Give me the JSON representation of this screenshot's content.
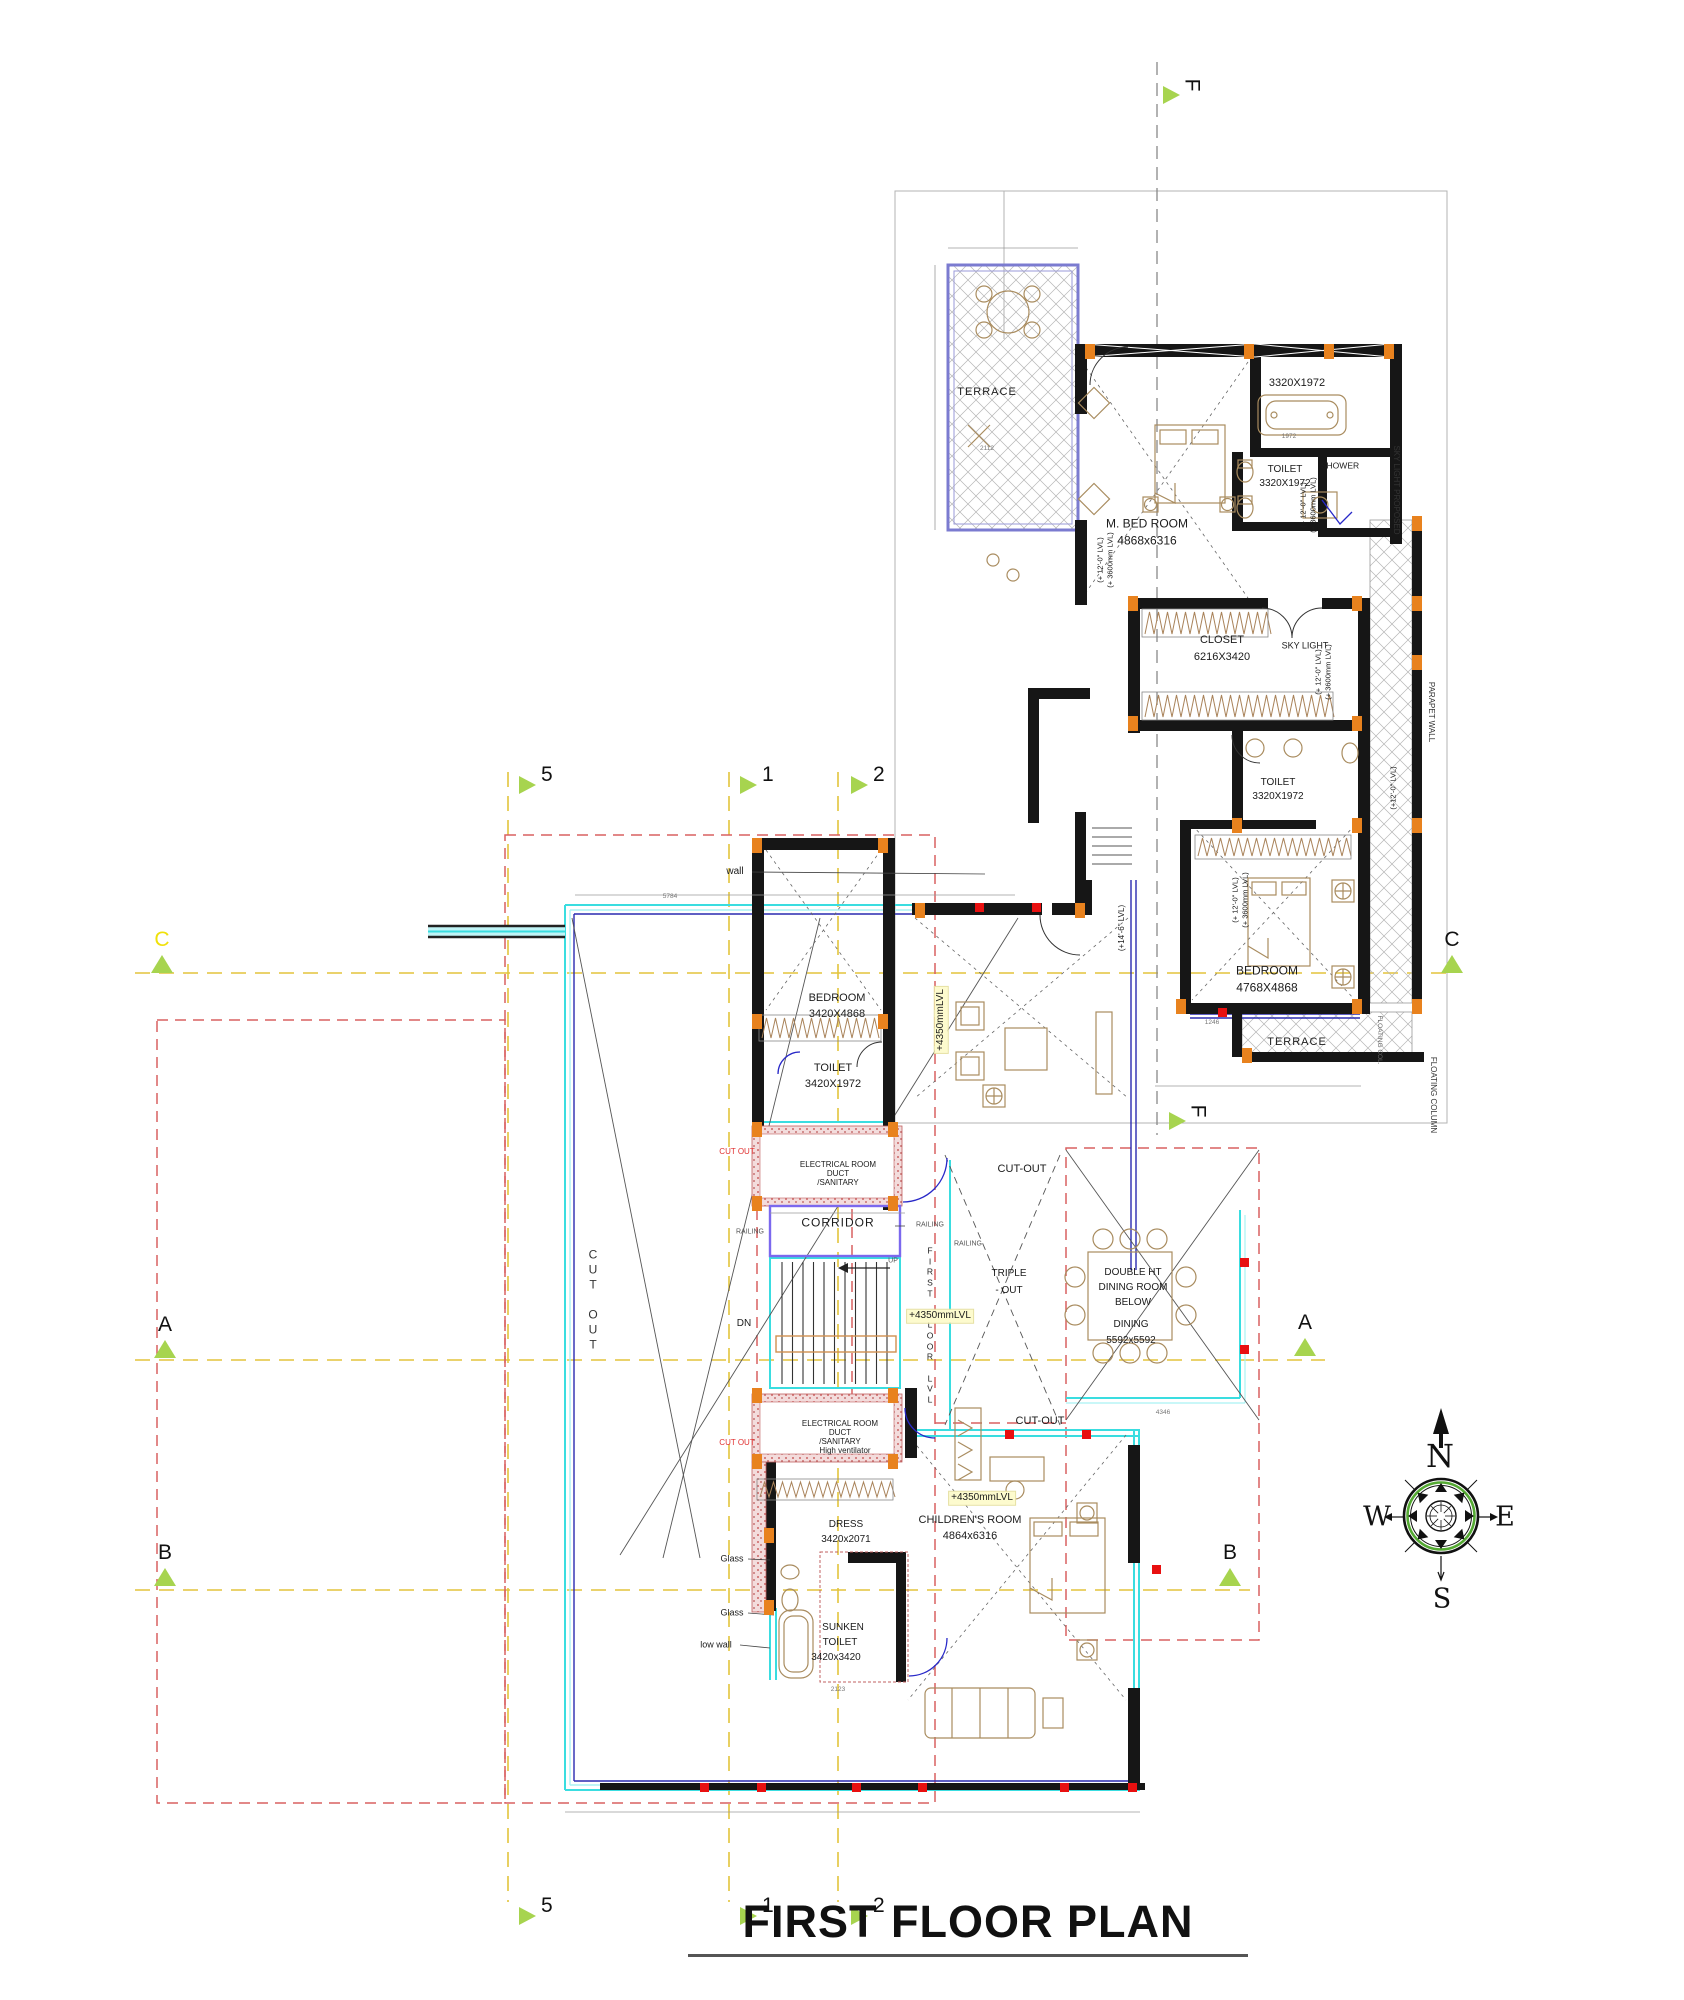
{
  "title": {
    "text": "FIRST FLOOR PLAN"
  },
  "compass": {
    "n": "N",
    "e": "E",
    "s": "S",
    "w": "W"
  },
  "colors": {
    "accent_green": "#a7d44f",
    "grid_yellow": "#e3c43c",
    "wall_black": "#161616",
    "column_orange": "#e8821e",
    "marker_red": "#e81010",
    "cyan": "#3adde0",
    "red_dash": "#d96060",
    "navy": "#4040bb",
    "highlight_yellow": "#fdfbce",
    "label_yellow": "#f0e10a"
  },
  "section_markers": [
    {
      "label": "F",
      "x": 1163,
      "y": 86,
      "dir": "r",
      "lr": 90
    },
    {
      "label": "F",
      "x": 1169,
      "y": 1112,
      "dir": "r",
      "lr": 90
    },
    {
      "label": "5",
      "x": 519,
      "y": 776,
      "dir": "r"
    },
    {
      "label": "1",
      "x": 740,
      "y": 776,
      "dir": "r"
    },
    {
      "label": "2",
      "x": 851,
      "y": 776,
      "dir": "r"
    },
    {
      "label": "5",
      "x": 519,
      "y": 1907,
      "dir": "r"
    },
    {
      "label": "1",
      "x": 740,
      "y": 1907,
      "dir": "r"
    },
    {
      "label": "2",
      "x": 851,
      "y": 1907,
      "dir": "r"
    },
    {
      "label": "C",
      "x": 151,
      "y": 955,
      "dir": "u",
      "lc": "#f0e10a"
    },
    {
      "label": "C",
      "x": 1441,
      "y": 955,
      "dir": "u"
    },
    {
      "label": "A",
      "x": 154,
      "y": 1340,
      "dir": "u"
    },
    {
      "label": "A",
      "x": 1294,
      "y": 1338,
      "dir": "u"
    },
    {
      "label": "B",
      "x": 154,
      "y": 1568,
      "dir": "u"
    },
    {
      "label": "B",
      "x": 1219,
      "y": 1568,
      "dir": "u"
    }
  ],
  "labels": [
    {
      "n": "terrace-1-label",
      "t": "TERRACE",
      "x": 987,
      "y": 393,
      "s": 11,
      "ls": 1
    },
    {
      "n": "master-bedroom-label",
      "t": "M. BED ROOM",
      "x": 1147,
      "y": 524,
      "s": 12
    },
    {
      "n": "master-bedroom-dims",
      "t": "4868x6316",
      "x": 1147,
      "y": 541,
      "s": 12
    },
    {
      "n": "bath-dims",
      "t": "3320X1972",
      "x": 1297,
      "y": 384,
      "s": 11
    },
    {
      "n": "toilet-1-label",
      "t": "TOILET",
      "x": 1285,
      "y": 470,
      "s": 10
    },
    {
      "n": "toilet-1-dims",
      "t": "3320X1972",
      "x": 1285,
      "y": 484,
      "s": 10
    },
    {
      "n": "shower-label",
      "t": "SHOWER",
      "x": 1340,
      "y": 466,
      "s": 8.5
    },
    {
      "n": "closet-label",
      "t": "CLOSET",
      "x": 1222,
      "y": 641,
      "s": 11
    },
    {
      "n": "closet-dims",
      "t": "6216X3420",
      "x": 1222,
      "y": 658,
      "s": 11
    },
    {
      "n": "sky-light-label",
      "t": "SKY LIGHT",
      "x": 1305,
      "y": 646,
      "s": 9
    },
    {
      "n": "toilet-2-label",
      "t": "TOILET",
      "x": 1278,
      "y": 783,
      "s": 10
    },
    {
      "n": "toilet-2-dims",
      "t": "3320X1972",
      "x": 1278,
      "y": 797,
      "s": 10
    },
    {
      "n": "bedroom-upper-label",
      "t": "BEDROOM",
      "x": 1267,
      "y": 971,
      "s": 12
    },
    {
      "n": "bedroom-upper-dims",
      "t": "4768X4868",
      "x": 1267,
      "y": 988,
      "s": 12
    },
    {
      "n": "terrace-2-label",
      "t": "TERRACE",
      "x": 1297,
      "y": 1043,
      "s": 11,
      "ls": 1
    },
    {
      "n": "sky-light-proposed-note",
      "t": "SKY LIGHT PROPOSED",
      "x": 1396,
      "y": 490,
      "s": 8,
      "r": 90,
      "c": "#333"
    },
    {
      "n": "parapet-wall-note",
      "t": "PARAPET WALL",
      "x": 1431,
      "y": 712,
      "s": 8,
      "r": 90,
      "c": "#333"
    },
    {
      "n": "floating-column-note",
      "t": "FLOATING COLUMN",
      "x": 1433,
      "y": 1095,
      "s": 8,
      "r": 90,
      "c": "#333"
    },
    {
      "n": "floating-col-note",
      "t": "FLOATING COL.",
      "x": 1379,
      "y": 1040,
      "s": 6.5,
      "r": 90,
      "c": "#666"
    },
    {
      "n": "level-note",
      "t": "(+ 12'-0\" LVL)",
      "x": 1100,
      "y": 560,
      "s": 7.5,
      "r": -90
    },
    {
      "n": "level-note",
      "t": "(+ 3600mm LVL)",
      "x": 1110,
      "y": 560,
      "s": 7.5,
      "r": -90
    },
    {
      "n": "level-note",
      "t": "(+ 12'-0\" LVL)",
      "x": 1303,
      "y": 505,
      "s": 7.5,
      "r": -90
    },
    {
      "n": "level-note",
      "t": "(+ 3600mm LVL)",
      "x": 1313,
      "y": 505,
      "s": 7.5,
      "r": -90
    },
    {
      "n": "level-note",
      "t": "(+ 12'-0\" LVL)",
      "x": 1318,
      "y": 672,
      "s": 7.5,
      "r": -90
    },
    {
      "n": "level-note",
      "t": "(+ 3600mm LVL)",
      "x": 1328,
      "y": 672,
      "s": 7.5,
      "r": -90
    },
    {
      "n": "level-note",
      "t": "(+ 12'-0\" LVL)",
      "x": 1235,
      "y": 900,
      "s": 7.5,
      "r": -90
    },
    {
      "n": "level-note",
      "t": "(+ 3600mm LVL)",
      "x": 1245,
      "y": 900,
      "s": 7.5,
      "r": -90
    },
    {
      "n": "level-note",
      "t": "(+12'-0\" LVL)",
      "x": 1393,
      "y": 788,
      "s": 7.5,
      "r": -90
    },
    {
      "n": "level-note",
      "t": "(+14'-6\" LVL)",
      "x": 1122,
      "y": 928,
      "s": 8,
      "r": -90
    },
    {
      "n": "wall-note",
      "t": "wall",
      "x": 735,
      "y": 872,
      "s": 10
    },
    {
      "n": "bedroom-2-label",
      "t": "BEDROOM",
      "x": 837,
      "y": 999,
      "s": 11
    },
    {
      "n": "bedroom-2-dims",
      "t": "3420X4868",
      "x": 837,
      "y": 1015,
      "s": 11
    },
    {
      "n": "toilet-3-label",
      "t": "TOILET",
      "x": 833,
      "y": 1069,
      "s": 11
    },
    {
      "n": "toilet-3-dims",
      "t": "3420X1972",
      "x": 833,
      "y": 1085,
      "s": 11
    },
    {
      "n": "electrical-room-1",
      "t": "ELECTRICAL ROOM",
      "x": 838,
      "y": 1165,
      "s": 8
    },
    {
      "n": "electrical-room-1",
      "t": "DUCT",
      "x": 838,
      "y": 1174,
      "s": 8
    },
    {
      "n": "electrical-room-1",
      "t": "/SANITARY",
      "x": 838,
      "y": 1183,
      "s": 8
    },
    {
      "n": "corridor-label",
      "t": "CORRIDOR",
      "x": 838,
      "y": 1223,
      "s": 12,
      "ls": 1
    },
    {
      "n": "cut-out-red",
      "t": "CUT OUT",
      "x": 737,
      "y": 1152,
      "s": 8,
      "c": "#e03030"
    },
    {
      "n": "cut-out-red",
      "t": "CUT OUT",
      "x": 737,
      "y": 1443,
      "s": 8,
      "c": "#e03030"
    },
    {
      "n": "cut-out-label",
      "t": "CUT-OUT",
      "x": 1022,
      "y": 1170,
      "s": 11
    },
    {
      "n": "cut-out-label",
      "t": "CUT-OUT",
      "x": 1040,
      "y": 1422,
      "s": 11
    },
    {
      "n": "railing-label",
      "t": "RAILING",
      "x": 930,
      "y": 1226,
      "s": 7,
      "c": "#555"
    },
    {
      "n": "railing-label",
      "t": "RAILING",
      "x": 968,
      "y": 1245,
      "s": 7,
      "c": "#555"
    },
    {
      "n": "railing-label",
      "t": "RAILING",
      "x": 750,
      "y": 1233,
      "s": 7,
      "c": "#555"
    },
    {
      "n": "triple-ht-cutout",
      "t": "TRIPLE",
      "x": 1009,
      "y": 1274,
      "s": 10
    },
    {
      "n": "triple-ht-cutout",
      "t": "- OUT",
      "x": 1009,
      "y": 1291,
      "s": 10
    },
    {
      "n": "first-floor-lvl",
      "t": "F\nI\nR\nS\nT\n\nF\nL\nO\nO\nR\n\nL\nV\nL",
      "x": 930,
      "y": 1325,
      "s": 8.5,
      "pre": true,
      "c": "#222"
    },
    {
      "n": "cut-out-vertical",
      "t": "C\nU\nT\n\nO\nU\nT",
      "x": 593,
      "y": 1300,
      "s": 12,
      "pre": true,
      "c": "#333"
    },
    {
      "n": "level-highlight",
      "t": "+4350mmLVL",
      "x": 941,
      "y": 1020,
      "s": 10,
      "r": -90,
      "bg": "#fdfbce"
    },
    {
      "n": "level-highlight",
      "t": "+4350mmLVL",
      "x": 940,
      "y": 1316,
      "s": 10,
      "bg": "#fdfbce"
    },
    {
      "n": "level-highlight",
      "t": "+4350mmLVL",
      "x": 982,
      "y": 1498,
      "s": 10,
      "bg": "#fdfbce"
    },
    {
      "n": "dn-label",
      "t": "DN",
      "x": 744,
      "y": 1324,
      "s": 10
    },
    {
      "n": "up-label",
      "t": "UP",
      "x": 893,
      "y": 1262,
      "s": 7,
      "c": "#555"
    },
    {
      "n": "dining-label",
      "t": "DOUBLE HT",
      "x": 1133,
      "y": 1273,
      "s": 10
    },
    {
      "n": "dining-label",
      "t": "DINING ROOM",
      "x": 1133,
      "y": 1288,
      "s": 10
    },
    {
      "n": "dining-label",
      "t": "BELOW",
      "x": 1133,
      "y": 1303,
      "s": 10
    },
    {
      "n": "dining-label",
      "t": "DINING",
      "x": 1131,
      "y": 1325,
      "s": 10
    },
    {
      "n": "dining-dims",
      "t": "5592x5592",
      "x": 1131,
      "y": 1341,
      "s": 10
    },
    {
      "n": "childrens-room-label",
      "t": "CHILDREN'S ROOM",
      "x": 970,
      "y": 1521,
      "s": 11
    },
    {
      "n": "childrens-room-dims",
      "t": "4864x6316",
      "x": 970,
      "y": 1537,
      "s": 11
    },
    {
      "n": "electrical-room-2",
      "t": "ELECTRICAL ROOM",
      "x": 840,
      "y": 1424,
      "s": 8
    },
    {
      "n": "electrical-room-2",
      "t": "DUCT",
      "x": 840,
      "y": 1433,
      "s": 8
    },
    {
      "n": "electrical-room-2",
      "t": "/SANITARY",
      "x": 840,
      "y": 1442,
      "s": 8
    },
    {
      "n": "electrical-room-2",
      "t": "High ventilator",
      "x": 845,
      "y": 1451,
      "s": 8
    },
    {
      "n": "dress-label",
      "t": "DRESS",
      "x": 846,
      "y": 1525,
      "s": 10
    },
    {
      "n": "dress-dims",
      "t": "3420x2071",
      "x": 846,
      "y": 1540,
      "s": 10
    },
    {
      "n": "sunken-toilet-label",
      "t": "SUNKEN",
      "x": 843,
      "y": 1628,
      "s": 10
    },
    {
      "n": "sunken-toilet-label",
      "t": "TOILET",
      "x": 840,
      "y": 1643,
      "s": 10
    },
    {
      "n": "sunken-toilet-dims",
      "t": "3420x3420",
      "x": 836,
      "y": 1658,
      "s": 10
    },
    {
      "n": "glass-note",
      "t": "Glass",
      "x": 732,
      "y": 1559,
      "s": 9
    },
    {
      "n": "glass-note",
      "t": "Glass",
      "x": 732,
      "y": 1613,
      "s": 9
    },
    {
      "n": "low-wall-note",
      "t": "low wall",
      "x": 716,
      "y": 1645,
      "s": 9
    },
    {
      "n": "dim-text",
      "t": "2112",
      "x": 987,
      "y": 449,
      "s": 6.5,
      "c": "#777"
    },
    {
      "n": "dim-text",
      "t": "1972",
      "x": 1289,
      "y": 437,
      "s": 6.5,
      "c": "#777"
    },
    {
      "n": "dim-text",
      "t": "5784",
      "x": 670,
      "y": 897,
      "s": 6.5,
      "c": "#777"
    },
    {
      "n": "dim-text",
      "t": "1246",
      "x": 1212,
      "y": 1023,
      "s": 6.5,
      "c": "#777"
    },
    {
      "n": "dim-text",
      "t": "4346",
      "x": 1163,
      "y": 1413,
      "s": 6.5,
      "c": "#777"
    },
    {
      "n": "dim-text",
      "t": "2123",
      "x": 838,
      "y": 1690,
      "s": 6.5,
      "c": "#777"
    }
  ]
}
